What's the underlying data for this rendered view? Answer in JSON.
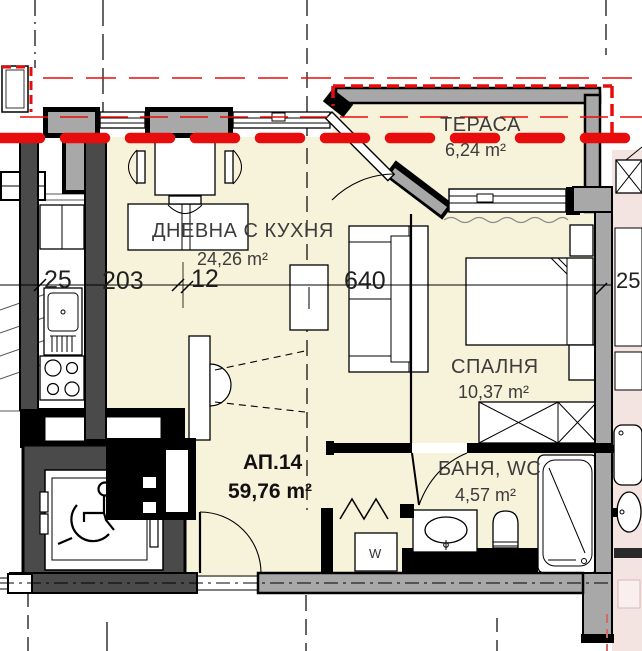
{
  "plan": {
    "apartment": {
      "id": "АП.14",
      "total_area": "59,76 m²"
    },
    "rooms": [
      {
        "key": "terrace",
        "name": "ТЕРАСА",
        "area": "6,24 m²"
      },
      {
        "key": "living-kitchen",
        "name": "ДНЕВНА С КУХНЯ",
        "area": "24,26 m²"
      },
      {
        "key": "bedroom",
        "name": "СПАЛНЯ",
        "area": "10,37 m²"
      },
      {
        "key": "bathroom",
        "name": "БАНЯ, WC",
        "area": "4,57 m²"
      }
    ],
    "dimensions": {
      "left_wall": "25",
      "kitchen_span": "203",
      "offset": "12",
      "bedroom_span": "640",
      "right_wall": "25"
    },
    "labels": {
      "washer": "W"
    },
    "colors": {
      "floor": "#f7f2da",
      "neighbor_floor": "#f3e4e2",
      "wall_insulation": "#a8a8a8",
      "wall_dark": "#4a4a4a",
      "outline": "#000000",
      "accent_red": "#e80c0c"
    }
  }
}
